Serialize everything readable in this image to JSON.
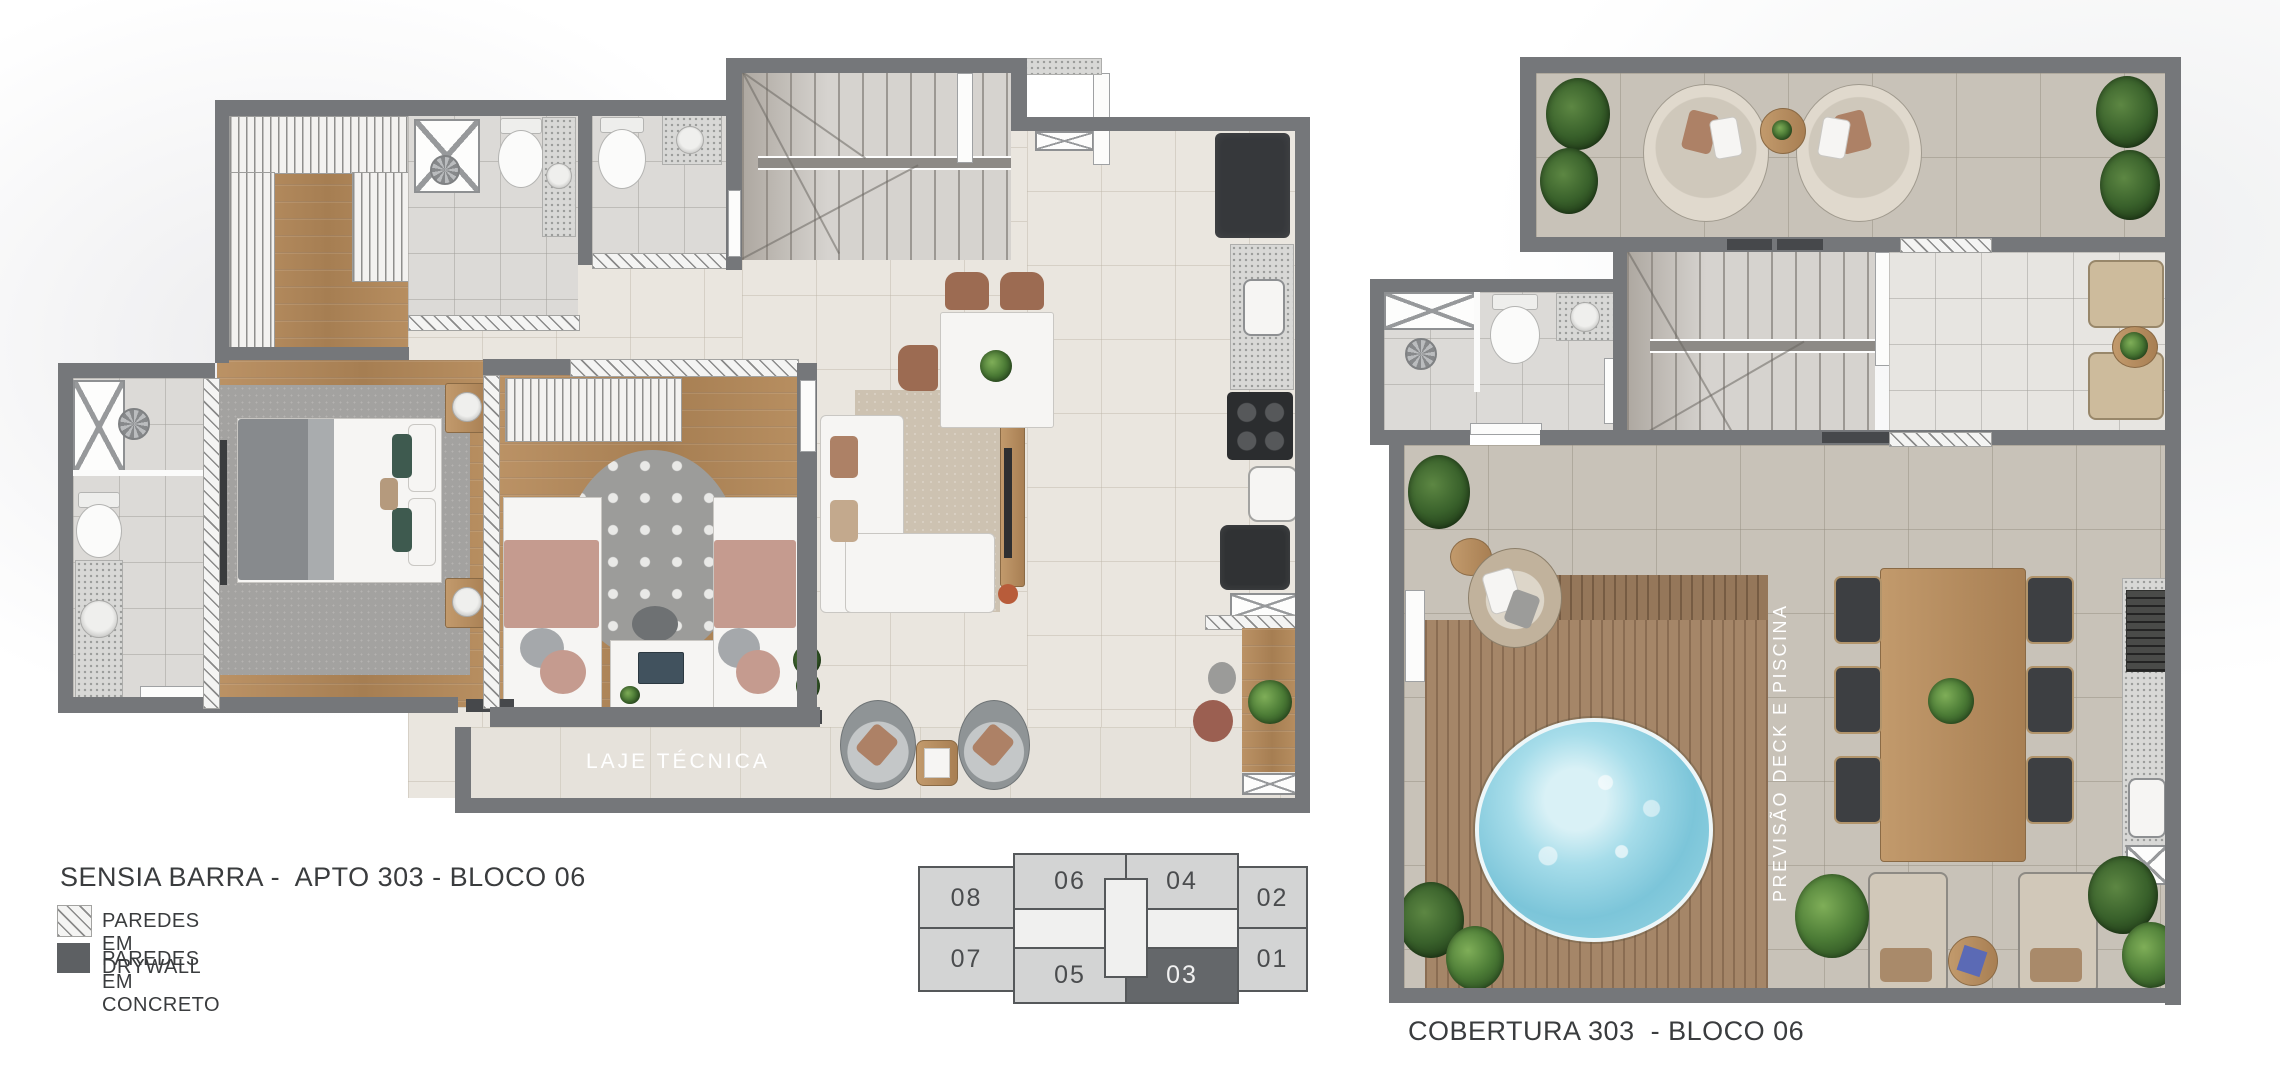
{
  "apartment_plan": {
    "title": "SENSIA BARRA -  APTO 303 - BLOCO 06",
    "laje_label": "LAJE TÉCNICA"
  },
  "roof_plan": {
    "title": "COBERTURA 303  - BLOCO 06",
    "deck_label": "PREVISÃO DECK E PISCINA"
  },
  "legend": {
    "items": [
      {
        "id": "drywall",
        "label": "PAREDES EM DRYWALL"
      },
      {
        "id": "concrete",
        "label": "PAREDES EM CONCRETO"
      }
    ]
  },
  "keyplan": {
    "highlighted_unit": "03",
    "units": [
      {
        "label": "08"
      },
      {
        "label": "06"
      },
      {
        "label": "04"
      },
      {
        "label": "02"
      },
      {
        "label": "07"
      },
      {
        "label": "05"
      },
      {
        "label": "03"
      },
      {
        "label": "01"
      }
    ]
  },
  "colors": {
    "wall_concrete": "#75777a",
    "legend_concrete_swatch": "#5d6063",
    "tile_interior": "#eae6df",
    "tile_terrace": "#c8c2b8",
    "wood_floor": "#b3895c",
    "deck_wood": "#a58668",
    "pool_water": "#8ed1e2",
    "plant_green": "#4c7c36",
    "keyplan_highlight": "#64676a",
    "text_dark": "#3a3c3e"
  }
}
